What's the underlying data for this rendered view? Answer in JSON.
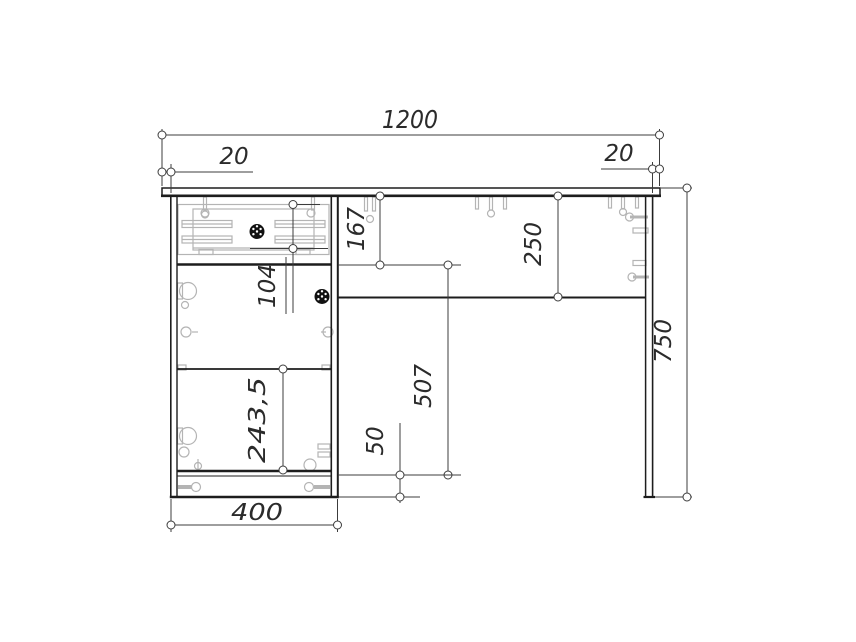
{
  "drawing": {
    "type": "furniture-assembly-drawing",
    "subject": "desk-front-elevation",
    "units": "mm",
    "colors": {
      "outline": "#1d1d1d",
      "fittings": "#b4b4b4",
      "dimension_lines": "#3c3c3c",
      "text": "#2b2b2b",
      "handle": "#111111",
      "background": "#ffffff"
    },
    "dimensions": {
      "overall_width": "1200",
      "top_overhang_left": "20",
      "top_overhang_right": "20",
      "drawer_section_height": "167",
      "apron_height": "250",
      "drawer_front_height": "104",
      "door_opening_height": "507",
      "shelf_spacing": "243,5",
      "plinth_height": "50",
      "cabinet_width": "400",
      "overall_height": "750"
    }
  }
}
